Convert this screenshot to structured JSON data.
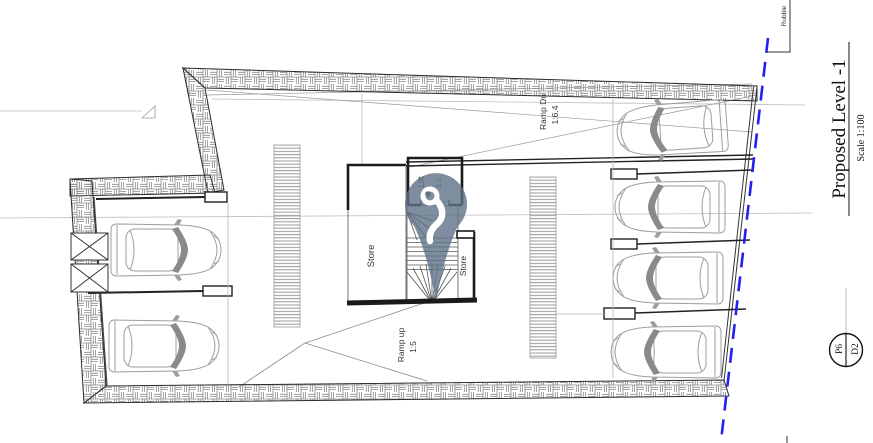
{
  "drawing": {
    "title": "Proposed Level -1",
    "scale_label": "Scale 1:100",
    "sheet_ref": {
      "primary": "P6",
      "secondary": "D2"
    },
    "boundary_note": "Rubble",
    "rooms": {
      "store_main": "Store",
      "store_small": "Store",
      "lift": "Lift",
      "lift_size": "1.5"
    },
    "ramps": {
      "down": {
        "line1": "Ramp Dn",
        "line2": "1:6.4"
      },
      "up": {
        "line1": "Ramp up",
        "line2": "1:5"
      }
    },
    "colors": {
      "site_boundary": "#2222ee",
      "pin_marker": "#5f7287",
      "wall_hatch": "#8a8a8a"
    }
  }
}
